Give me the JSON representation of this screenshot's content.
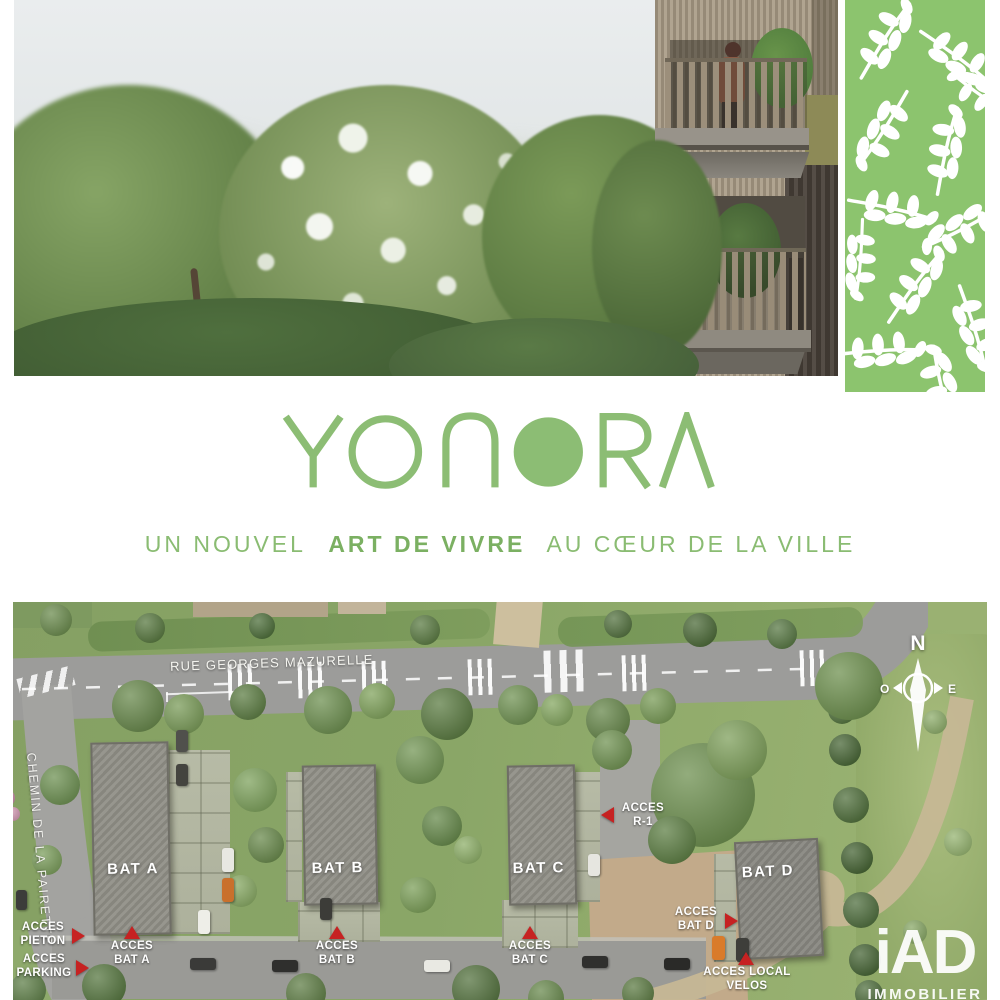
{
  "brand": {
    "name": "YONORA",
    "tagline": [
      "UN NOUVEL",
      "ART DE VIVRE",
      "AU CŒUR DE LA VILLE"
    ],
    "accent_green": "#8bbc72",
    "panel_green": "#8cc46e",
    "marker_red": "#c62222"
  },
  "siteplan": {
    "streets": {
      "main": "RUE GEORGES MAZURELLE",
      "side": "CHEMIN DE LA PAIRETTE"
    },
    "buildings": [
      {
        "label": "BAT A"
      },
      {
        "label": "BAT B"
      },
      {
        "label": "BAT C"
      },
      {
        "label": "BAT D"
      }
    ],
    "access_points": [
      {
        "line1": "ACCES",
        "line2": "PIETON",
        "arrow": "right"
      },
      {
        "line1": "ACCES",
        "line2": "PARKING",
        "arrow": "right"
      },
      {
        "line1": "ACCES",
        "line2": "BAT A",
        "arrow": "up"
      },
      {
        "line1": "ACCES",
        "line2": "BAT B",
        "arrow": "up"
      },
      {
        "line1": "ACCES",
        "line2": "BAT C",
        "arrow": "up"
      },
      {
        "line1": "ACCES",
        "line2": "R-1",
        "arrow": "left"
      },
      {
        "line1": "ACCES",
        "line2": "BAT D",
        "arrow": "right"
      },
      {
        "line1": "ACCES LOCAL",
        "line2": "VELOS",
        "arrow": "up"
      }
    ],
    "compass": {
      "north": "N",
      "west": "O",
      "east": "E"
    }
  },
  "watermark": {
    "logo": "iAD",
    "subtext": "IMMOBILIER"
  }
}
